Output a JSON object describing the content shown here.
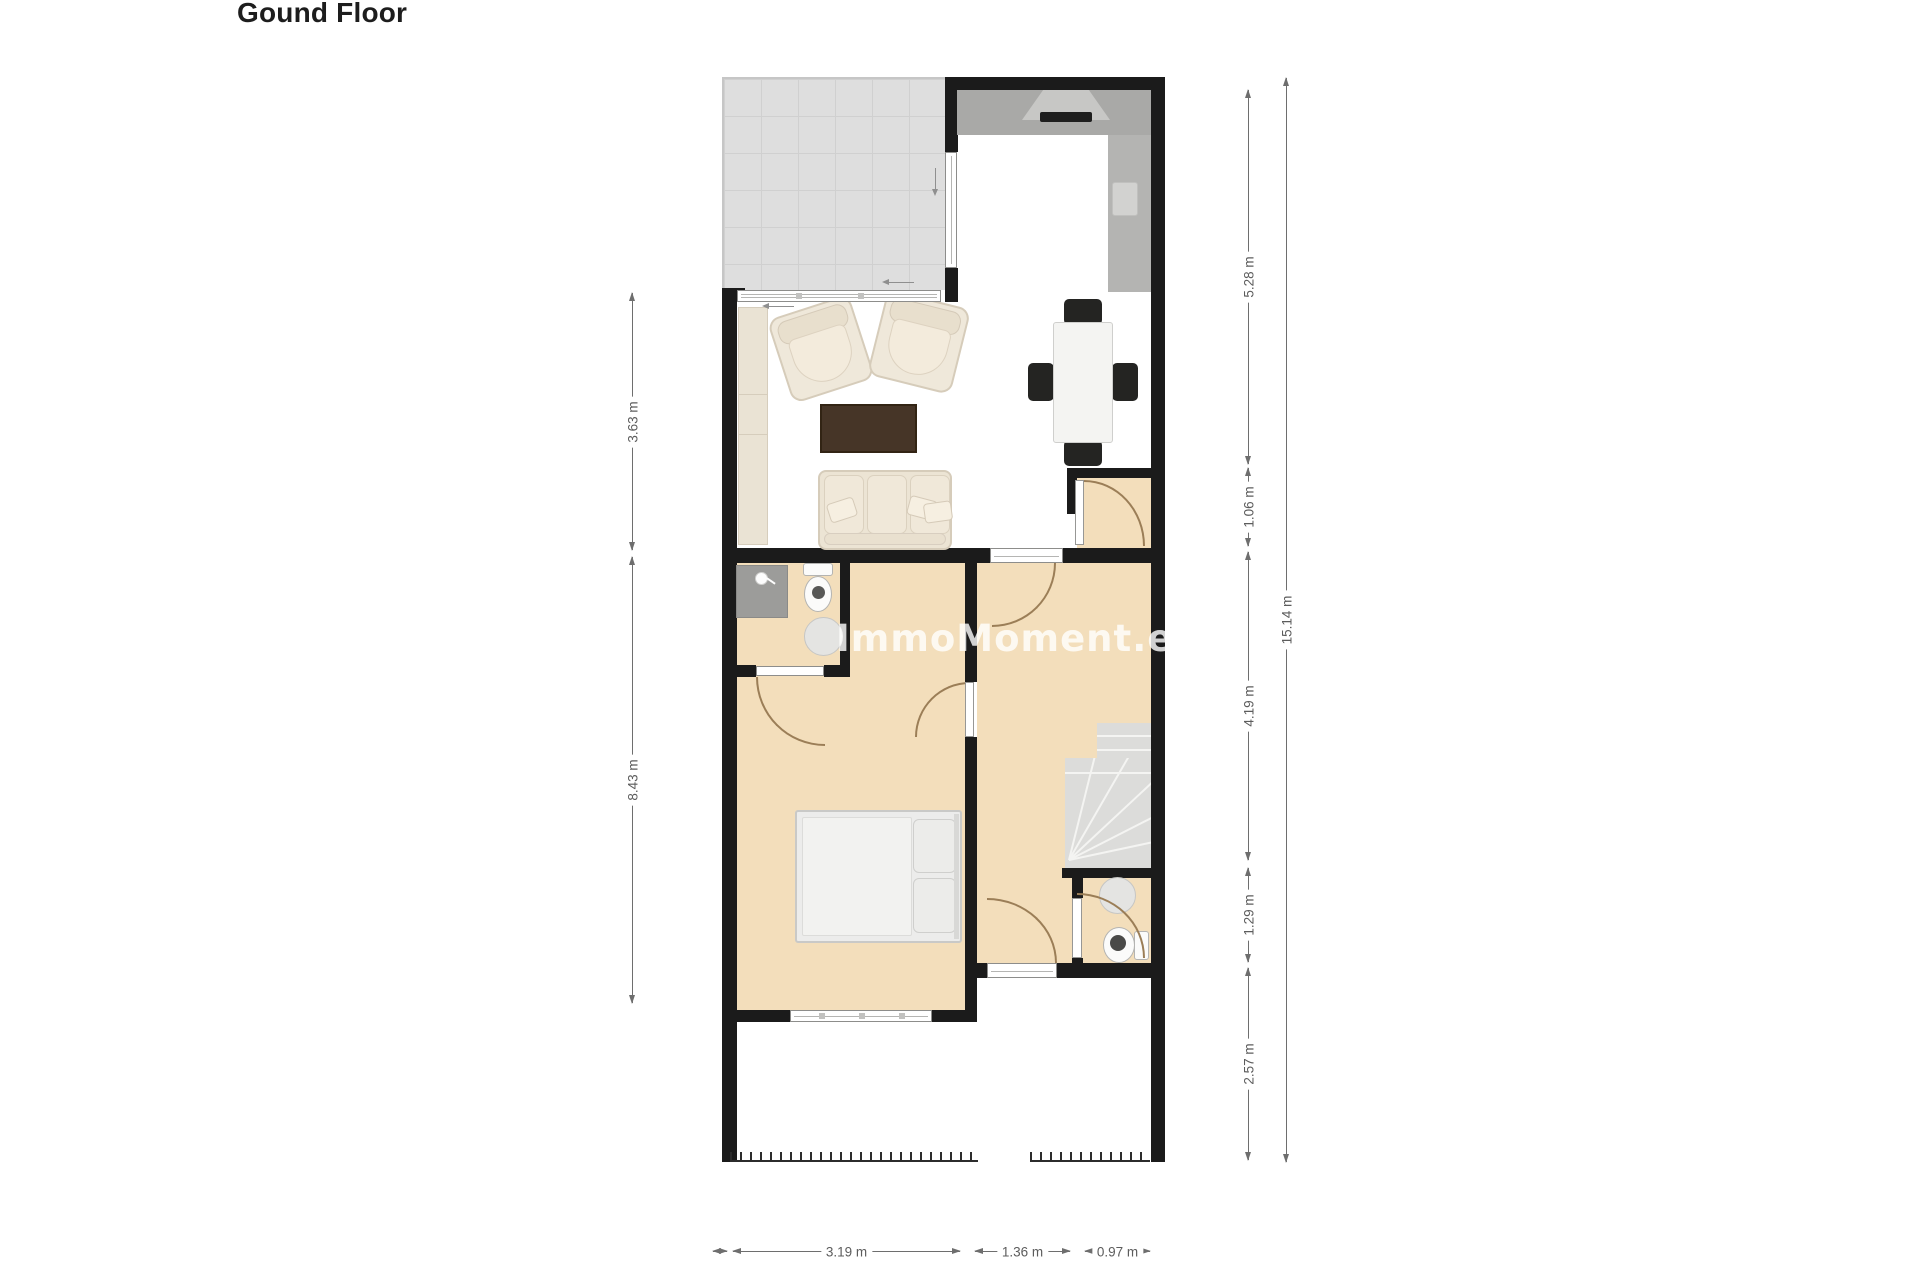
{
  "title": "Gound Floor",
  "watermark": "ImmoMoment.es",
  "dims": {
    "left": [
      "3.63 m",
      "8.43 m"
    ],
    "right_inner": [
      "5.28 m",
      "1.06 m",
      "4.19 m",
      "1.29 m",
      "2.57 m"
    ],
    "right_outer": [
      "15.14 m"
    ],
    "bottom": [
      "3.19 m",
      "1.36 m",
      "0.97 m"
    ]
  },
  "colors": {
    "wall": "#1b1b1b",
    "floor-beige": "#f3debb",
    "tile": "#dedede",
    "tile-line": "#d0d0d0",
    "counter": "#a9a9a7",
    "counter-2": "#b4b4b2",
    "cream": "#efe8da",
    "cream-line": "#d6ccba",
    "coffee": "#463527",
    "chair-dark": "#242422",
    "stair": "#dcdcda",
    "dim-line": "#6e6e6e",
    "dim-text": "#5c5c5c",
    "door-arc": "#9b7e57",
    "wm": "rgba(255,255,255,0.8)"
  }
}
